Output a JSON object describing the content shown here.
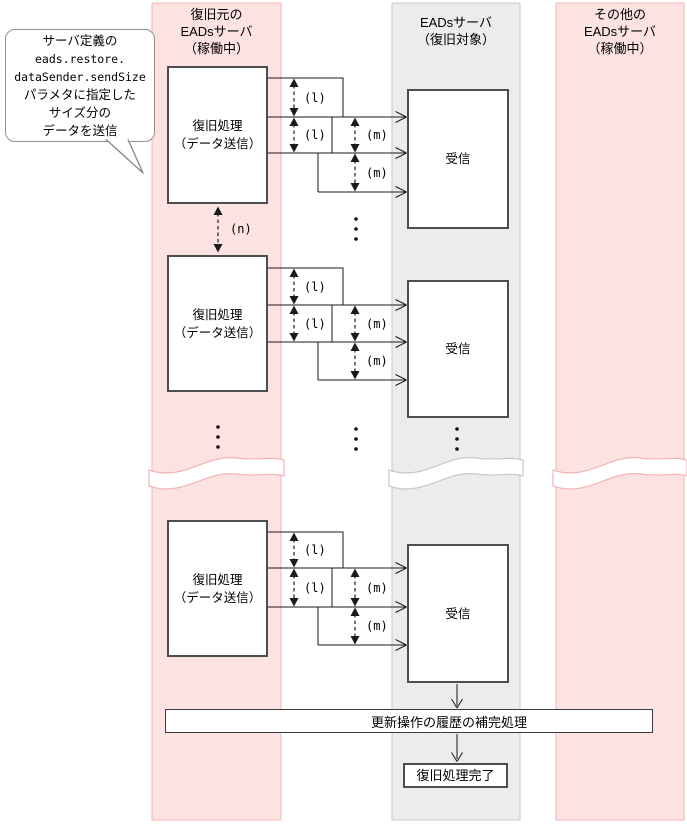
{
  "colors": {
    "lane_pink": "#FDE2E2",
    "lane_pink_border": "#F2B5B5",
    "lane_gray": "#ECECEC",
    "lane_gray_border": "#C9C9C9",
    "box_border": "#4D4D4D",
    "wire": "#1A1A1A"
  },
  "callout": {
    "lines": [
      "サーバ定義の",
      "eads.restore.",
      "dataSender.sendSize",
      "パラメタに指定した",
      "サイズ分の",
      "データを送信"
    ]
  },
  "lanes": [
    {
      "title_lines": [
        "復旧元の",
        "EADsサーバ",
        "（稼働中）"
      ]
    },
    {
      "title_lines": [
        "EADsサーバ",
        "（復旧対象）"
      ]
    },
    {
      "title_lines": [
        "その他の",
        "EADsサーバ",
        "（稼働中）"
      ]
    }
  ],
  "process": {
    "sender_lines": [
      "復旧処理",
      "（データ送信）"
    ],
    "receiver": "受信"
  },
  "labels": {
    "l": "(l)",
    "m": "(m)",
    "n": "(n)"
  },
  "footer": {
    "history_bar": "更新操作の履歴の補完処理",
    "done": "復旧処理完了"
  }
}
